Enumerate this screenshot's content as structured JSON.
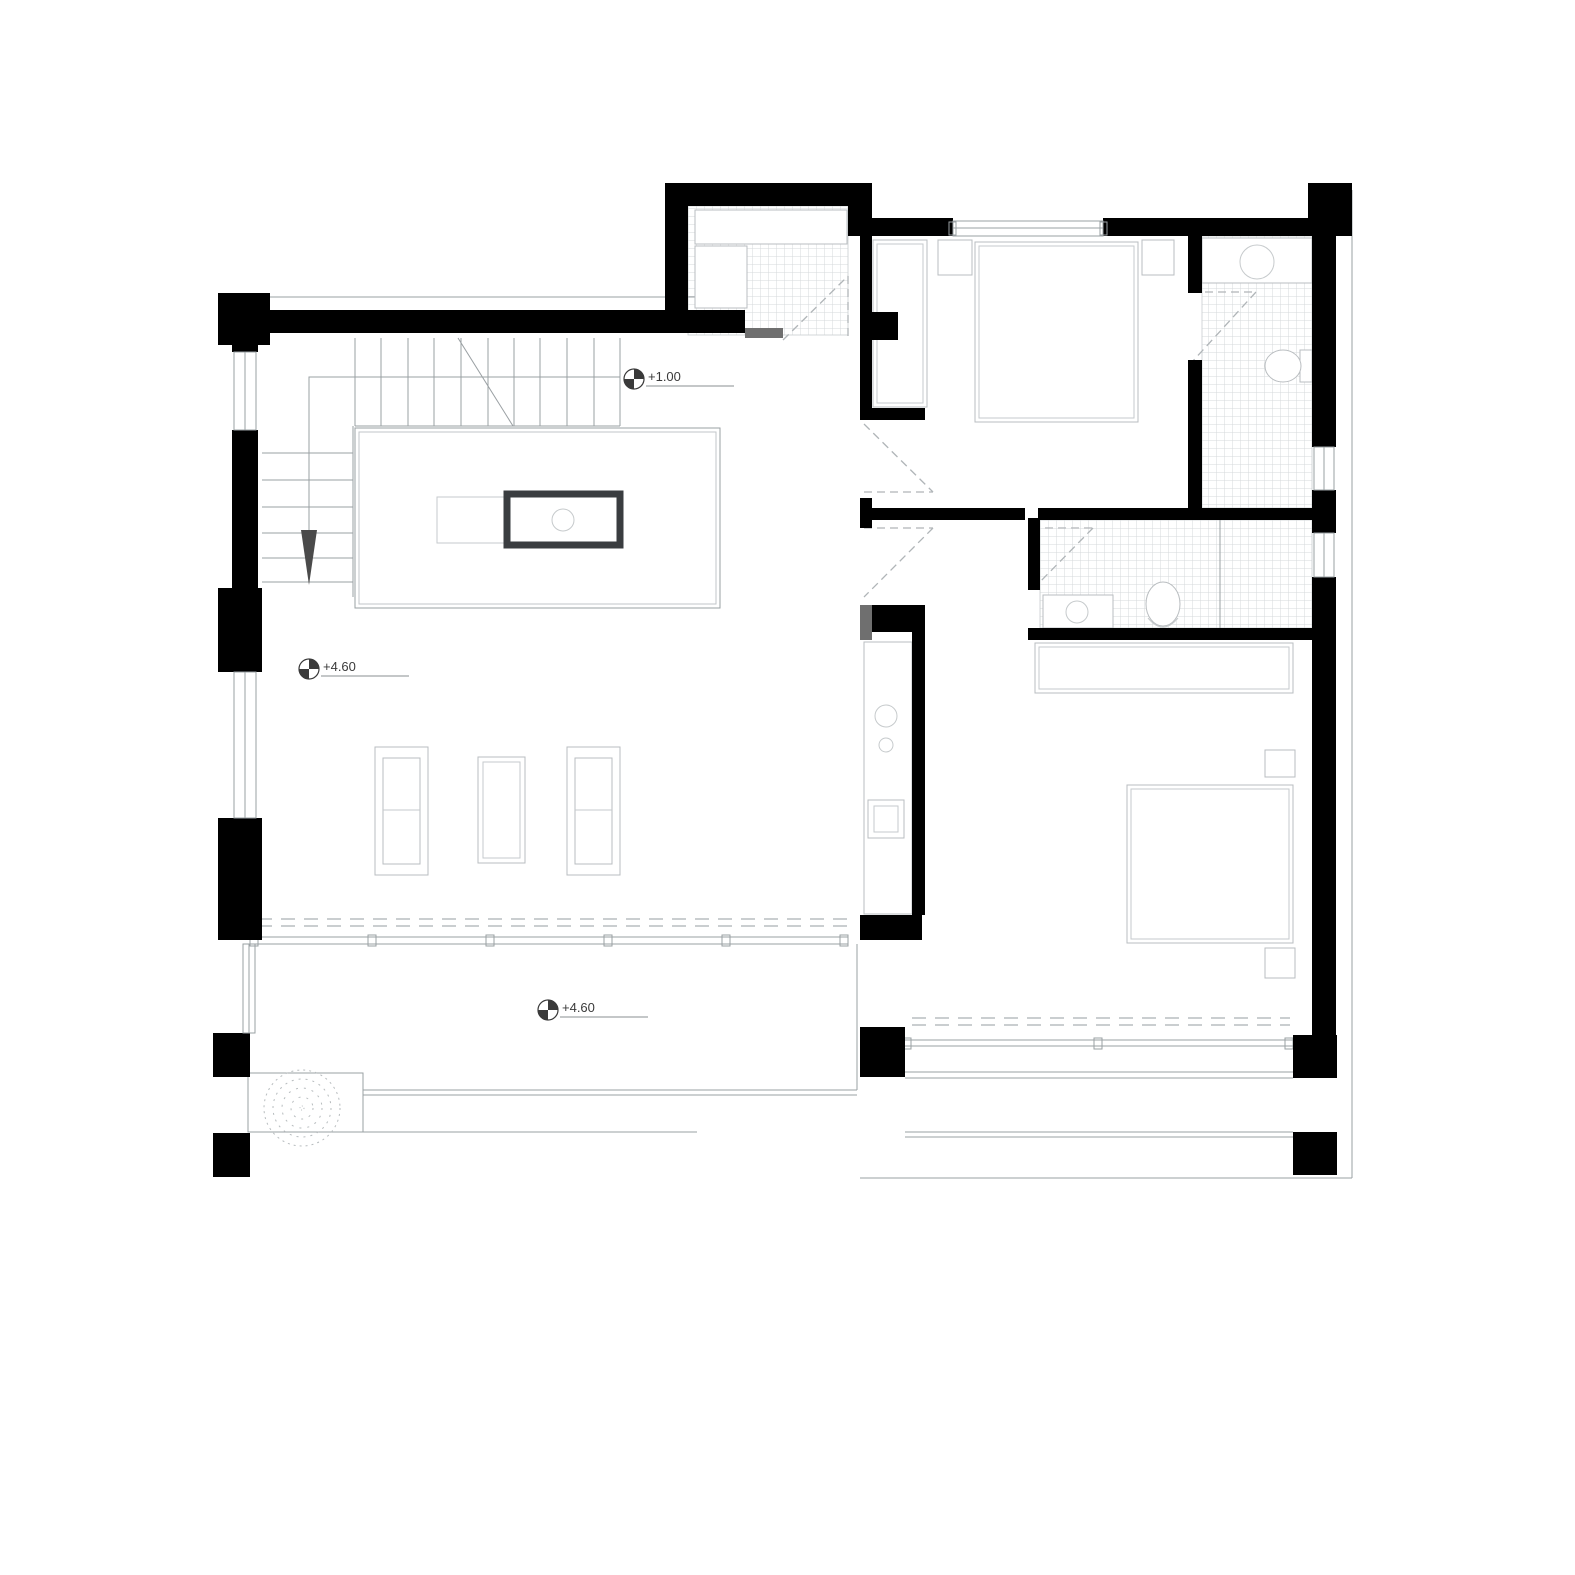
{
  "drawing": {
    "type": "architectural-floor-plan",
    "style": "black-and-white line drawing",
    "floor": "upper level with void, two bedrooms, three bathrooms, living area and terraces"
  },
  "colors": {
    "walls": "#000000",
    "door_leaf": "#6f6f6f",
    "floor_lines": "#9aa0a3",
    "furniture_lines": "#b9bdc0",
    "tile_grid": "#d6d9db",
    "dashed_swings": "#b0b5b8",
    "island_border": "#3a3d40",
    "text": "#3a3a3a"
  },
  "icons": {
    "level_marker": "benchmark-quadrant-circle",
    "tree": "stippled-dashed-circle",
    "stair_direction": "down-arrow-triangle"
  },
  "level_markers": [
    {
      "id": "stair-mid-landing",
      "value": "+1.00"
    },
    {
      "id": "upper-floor-living",
      "value": "+4.60"
    },
    {
      "id": "terrace",
      "value": "+4.60"
    }
  ]
}
